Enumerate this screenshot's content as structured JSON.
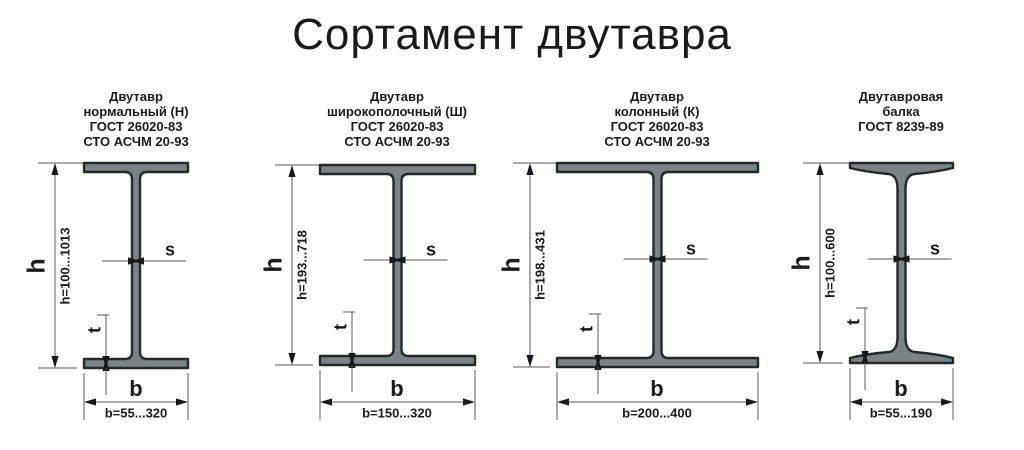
{
  "title": "Сортамент двутавра",
  "dimension_labels": {
    "height": "h",
    "width": "b",
    "web_thickness": "s",
    "flange_thickness": "t"
  },
  "beams": [
    {
      "header_lines": [
        "Двутавр",
        "нормальный (Н)",
        "ГОСТ 26020-83",
        "СТО АСЧМ 20-93"
      ],
      "h_range": "h=100...1013",
      "b_range": "b=55...320"
    },
    {
      "header_lines": [
        "Двутавр",
        "широкополочный (Ш)",
        "ГОСТ 26020-83",
        "СТО АСЧМ 20-93"
      ],
      "h_range": "h=193...718",
      "b_range": "b=150...320"
    },
    {
      "header_lines": [
        "Двутавр",
        "колонный (К)",
        "ГОСТ 26020-83",
        "СТО АСЧМ 20-93"
      ],
      "h_range": "h=198...431",
      "b_range": "b=200...400"
    },
    {
      "header_lines": [
        "Двутавровая",
        "балка",
        "ГОСТ 8239-89"
      ],
      "h_range": "h=100...600",
      "b_range": "b=55...190"
    }
  ],
  "colors": {
    "beam_fill": "#7c8386",
    "beam_outline": "#25292b",
    "dimension_line": "#54585b",
    "text": "#1b1b1b"
  }
}
